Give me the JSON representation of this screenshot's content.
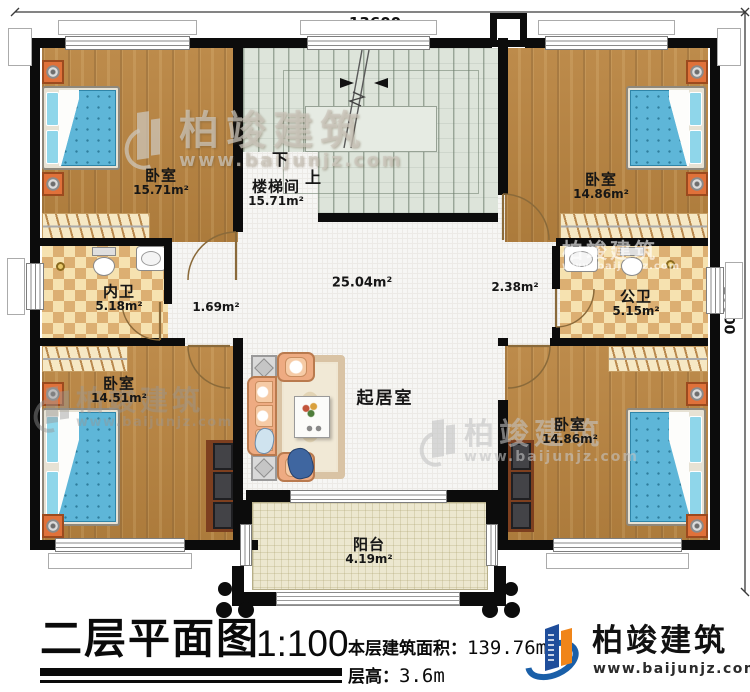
{
  "dimensions": {
    "top": "13600",
    "right": "10800"
  },
  "rooms": {
    "bedroom_tl": {
      "name": "卧室",
      "area": "15.71m²"
    },
    "stairwell": {
      "name": "楼梯间",
      "area": "15.71m²",
      "down_label": "下",
      "up_label": "上"
    },
    "bedroom_tr": {
      "name": "卧室",
      "area": "14.86m²"
    },
    "inner_bath": {
      "name": "内卫",
      "area": "5.18m²"
    },
    "public_bath": {
      "name": "公卫",
      "area": "5.15m²"
    },
    "hall_left": {
      "area": "1.69m²"
    },
    "hall_right": {
      "area": "2.38m²"
    },
    "living_room": {
      "name": "起居室",
      "area": "25.04m²"
    },
    "bedroom_bl": {
      "name": "卧室",
      "area": "14.51m²"
    },
    "bedroom_br": {
      "name": "卧室",
      "area": "14.86m²"
    },
    "balcony": {
      "name": "阳台",
      "area": "4.19m²"
    }
  },
  "title_block": {
    "title": "二层平面图",
    "scale": "1:100",
    "floor_area_label": "本层建筑面积：",
    "floor_area_value": "139.76m²",
    "floor_height_label": "层高：",
    "floor_height_value": "3.6m"
  },
  "brand": {
    "company": "柏竣建筑",
    "website": "www.baijunjz.com"
  },
  "colors": {
    "wall": "#0c0c0c",
    "wood_floor": "#b98440",
    "bath_tile": "#eccf96",
    "stair_floor": "#dde4da",
    "balcony_floor": "#ece7cf",
    "bed_blue": "#5eb6d8",
    "logo_blue": "#1f4e9b",
    "logo_orange": "#f08519"
  }
}
